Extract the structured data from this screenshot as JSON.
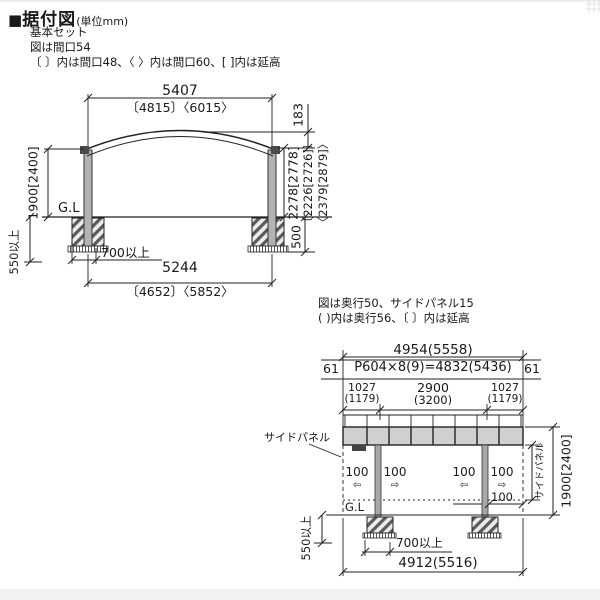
{
  "header": {
    "marker": "■",
    "title": "据付図",
    "unit": "(単位mm)",
    "line1": "基本セット",
    "line2": "図は間口54",
    "line3": "〔 〕内は間口48、〈 〉内は間口60、[ ]内は延高"
  },
  "front_view": {
    "width_top": "5407",
    "width_top_alt": "〔4815〕〈6015〉",
    "roof_rise": "183",
    "height_main": "2278[2778]",
    "height_alt48": "〔2226[2726]〕",
    "height_alt60": "〈2379[2879]〉",
    "height_left": "1900[2400]",
    "gl": "G.L",
    "embed_min": "550以上",
    "footing_depth": "500",
    "footing_offset": "700以上",
    "width_bottom": "5244",
    "width_bottom_alt": "〔4652〕〈5852〉"
  },
  "side_view": {
    "note1": "図は奥行50、サイドパネル15",
    "note2": "( )内は奥行56、〔 〕内は延高",
    "depth_top": "4954(5558)",
    "edge_left": "61",
    "pitch_formula": "P604×8(9)=4832(5436)",
    "edge_right": "61",
    "seg1": "1027",
    "seg1_alt": "(1179)",
    "seg2": "2900",
    "seg2_alt": "(3200)",
    "seg3": "1027",
    "seg3_alt": "(1179)",
    "side_panel_label": "サイドパネル",
    "offsets": [
      "100",
      "100",
      "100",
      "100"
    ],
    "arrows": [
      "⇦",
      "⇨",
      "⇦",
      "⇨"
    ],
    "panel_gap": "100",
    "gl": "G.L",
    "embed_min": "550以上",
    "footing_offset": "700以上",
    "depth_bottom": "4912(5516)",
    "side_panel_right": "サイドパネル",
    "height_right": "1900[2400]"
  },
  "colors": {
    "line": "#1a1a1a",
    "post_fill": "#b3b3b3",
    "band_fill": "#d0d0d0",
    "background": "#ffffff"
  }
}
